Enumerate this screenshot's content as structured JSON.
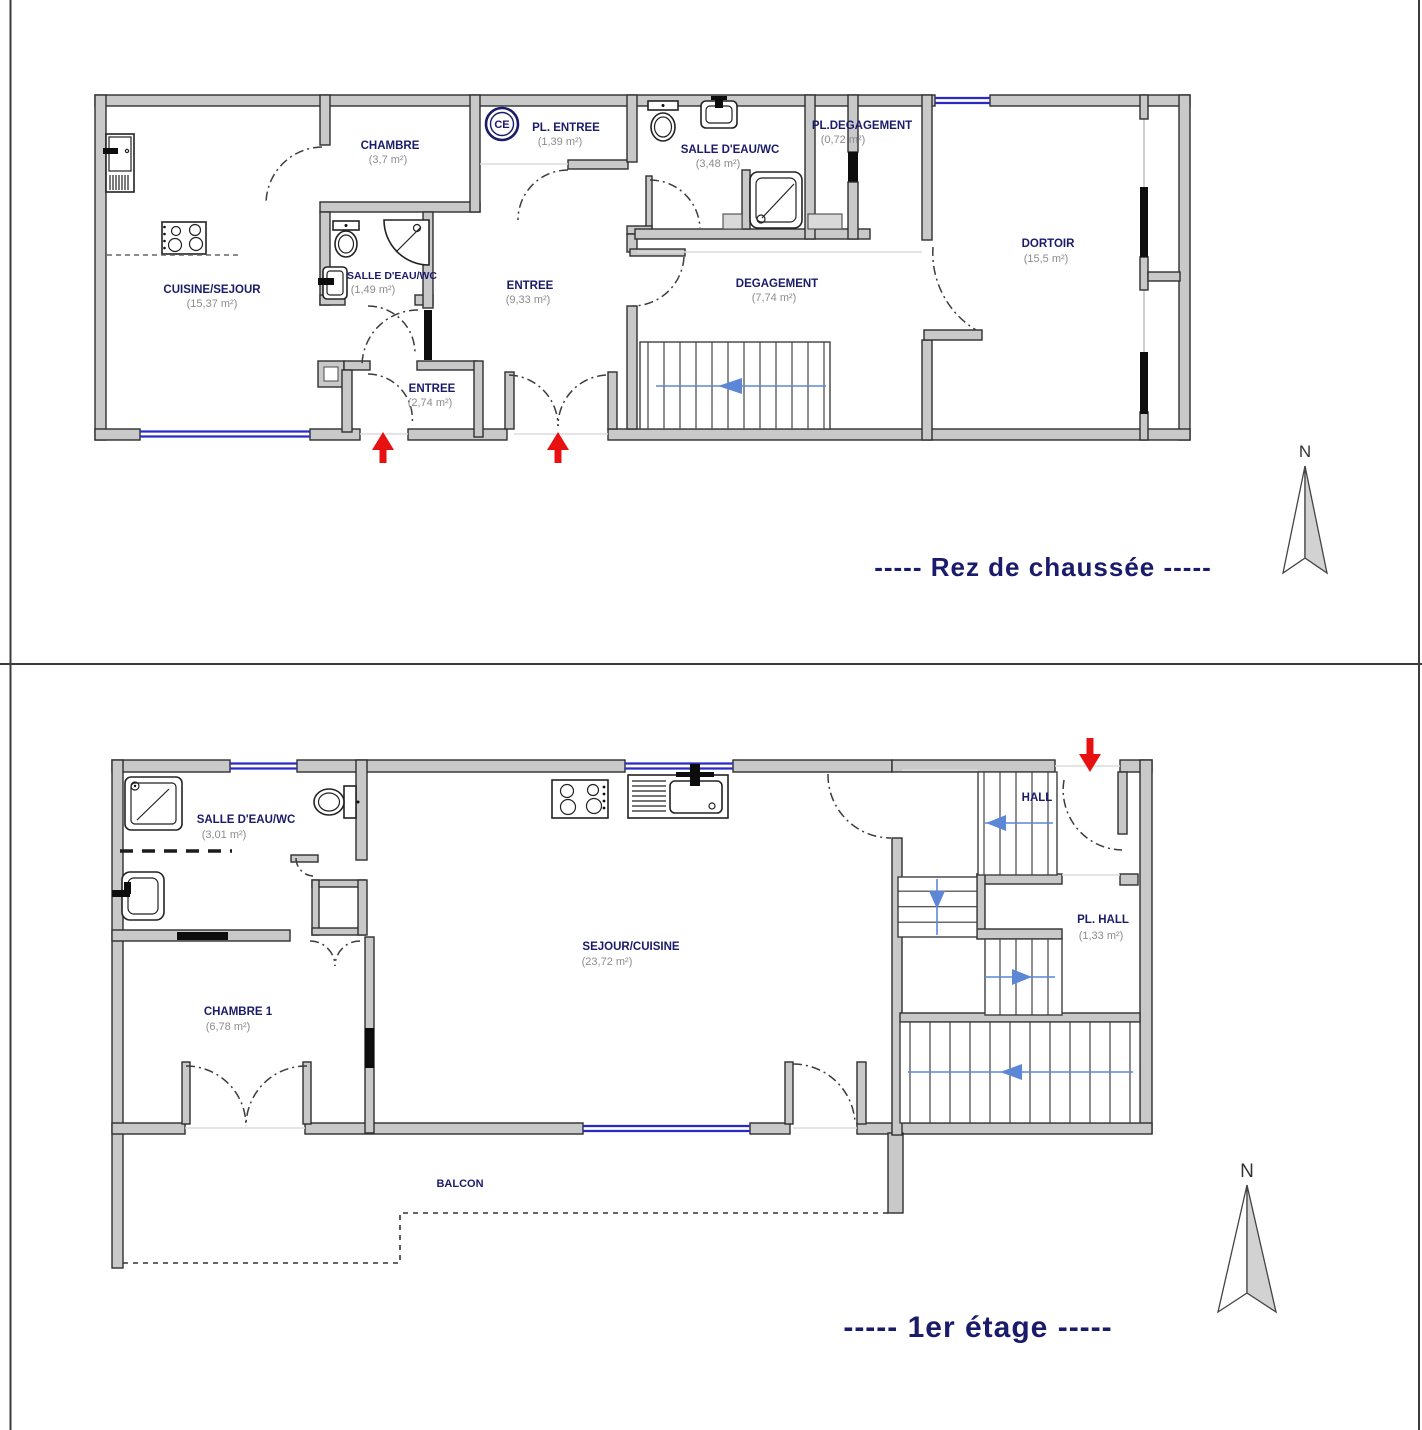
{
  "page": {
    "floor1_title": "-----  Rez de chaussée  -----",
    "floor2_title": "-----  1er étage  -----",
    "north_label": "N",
    "colors": {
      "room_name": "#1b1b6b",
      "room_area": "#8c8c8c",
      "wall_fill": "#c9c9c9",
      "window_blue": "#2a2ac8",
      "stair_arrow_blue": "#5b87d6",
      "entry_arrow_red": "#e81111"
    }
  },
  "ground_floor": {
    "ce_label": "CE",
    "rooms": {
      "cuisine_sejour": {
        "name": "CUISINE/SEJOUR",
        "area": "(15,37 m²)"
      },
      "chambre": {
        "name": "CHAMBRE",
        "area": "(3,7 m²)"
      },
      "pl_entree": {
        "name": "PL. ENTREE",
        "area": "(1,39 m²)"
      },
      "salle_eau_small": {
        "name": "SALLE D'EAU/WC",
        "area": "(1,49 m²)"
      },
      "entree_main": {
        "name": "ENTREE",
        "area": "(9,33 m²)"
      },
      "entree_small": {
        "name": "ENTREE",
        "area": "(2,74 m²)"
      },
      "salle_eau": {
        "name": "SALLE D'EAU/WC",
        "area": "(3,48 m²)"
      },
      "pl_degagement": {
        "name": "PL.DEGAGEMENT",
        "area": "(0,72 m²)"
      },
      "degagement": {
        "name": "DEGAGEMENT",
        "area": "(7,74 m²)"
      },
      "dortoir": {
        "name": "DORTOIR",
        "area": "(15,5 m²)"
      }
    }
  },
  "first_floor": {
    "rooms": {
      "salle_eau": {
        "name": "SALLE D'EAU/WC",
        "area": "(3,01 m²)"
      },
      "chambre1": {
        "name": "CHAMBRE 1",
        "area": "(6,78 m²)"
      },
      "sejour_cuisine": {
        "name": "SEJOUR/CUISINE",
        "area": "(23,72 m²)"
      },
      "hall": {
        "name": "HALL"
      },
      "pl_hall": {
        "name": "PL. HALL",
        "area": "(1,33 m²)"
      },
      "balcon": {
        "name": "BALCON"
      }
    }
  }
}
